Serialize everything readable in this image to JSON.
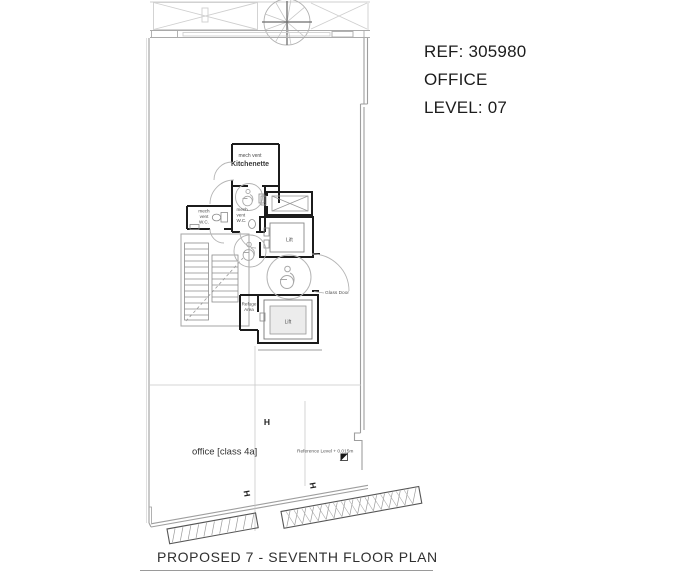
{
  "info_panel": {
    "ref": "REF: 305980",
    "use": "OFFICE",
    "level": "LEVEL: 07"
  },
  "caption": "PROPOSED 7 - SEVENTH FLOOR PLAN",
  "plan": {
    "labels": {
      "kitchen_vent": "mech vent",
      "kitchenette": "Kitchenette",
      "wc": {
        "l1": "mech",
        "l2": "vent",
        "l3": "W.C."
      },
      "lift": "Lift",
      "glass_door": "Glass Door",
      "refuge": {
        "l1": "Refuge",
        "l2": "Area"
      },
      "office": "office [class 4a]",
      "reference_level": "Reference Level + 0.015m",
      "column_marker": "H"
    },
    "colors": {
      "wall_dark": "#1c1c1c",
      "wall_outline": "#9e9e9e",
      "line_light": "#cfcfcf",
      "line_mid": "#b5b5b5",
      "grid": "#c9c9c9",
      "label_text": "#4a4a4a",
      "info_text": "#1c1c1c"
    }
  }
}
